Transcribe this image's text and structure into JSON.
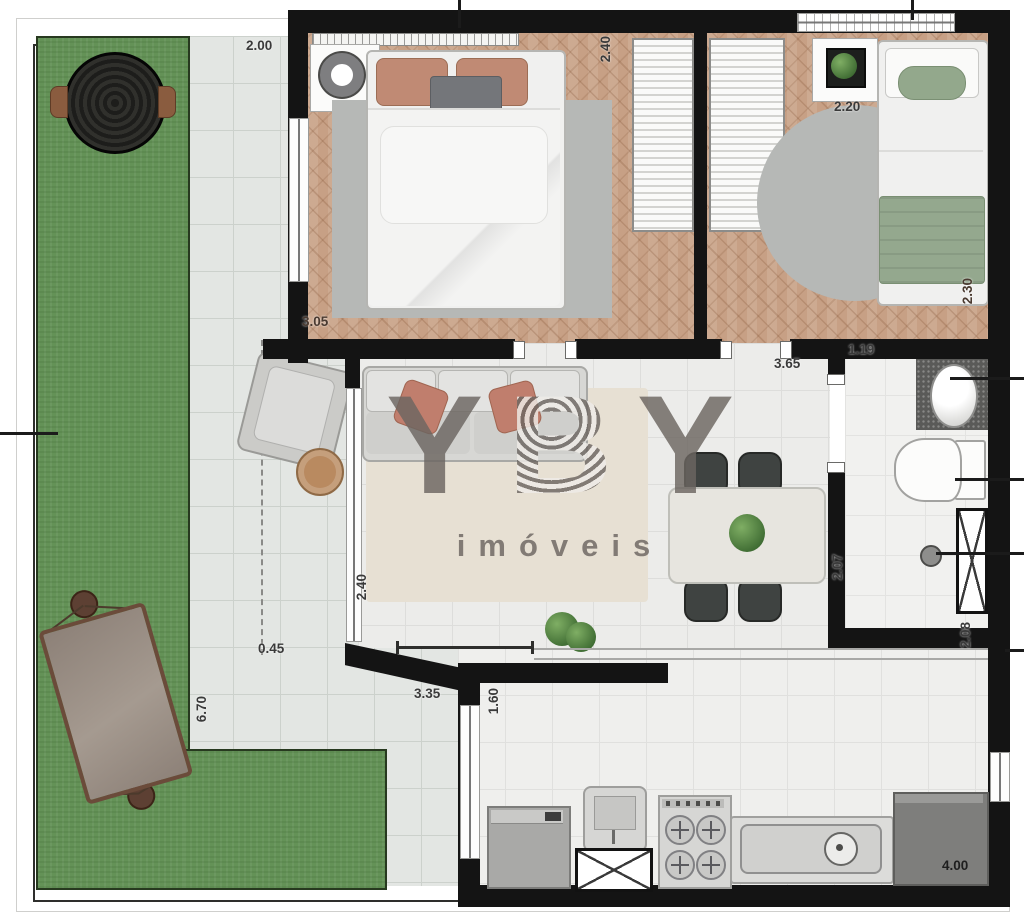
{
  "watermark": {
    "letters": [
      "Y",
      "B",
      "Y"
    ],
    "subtitle": "imóveis"
  },
  "labels": {
    "terrace_width": "2.00",
    "bedroom1_depth": "2.40",
    "bedroom1_width": "3.05",
    "bedroom2_width": "2.20",
    "bedroom2_depth": "2.30",
    "living_width": "3.65",
    "bath_hall": "1.19",
    "bath_depth": "2.07",
    "shaft_side": "2.08",
    "living_depth": "2.40",
    "terrace_notch": "0.45",
    "garden_depth": "6.70",
    "balcony_door": "3.35",
    "kitchen_door": "1.60",
    "kitchen_width": "4.00"
  },
  "colors": {
    "wall": "#141414",
    "grass": "#649257",
    "wood_floor": "#c7a085",
    "terrace_tile": "#e3e6e3",
    "accent_pillow": "#c07e6d",
    "bed_green": "#94a88e",
    "rug_gray": "#b6b8b6",
    "watermark_gray": "#6c6661"
  }
}
